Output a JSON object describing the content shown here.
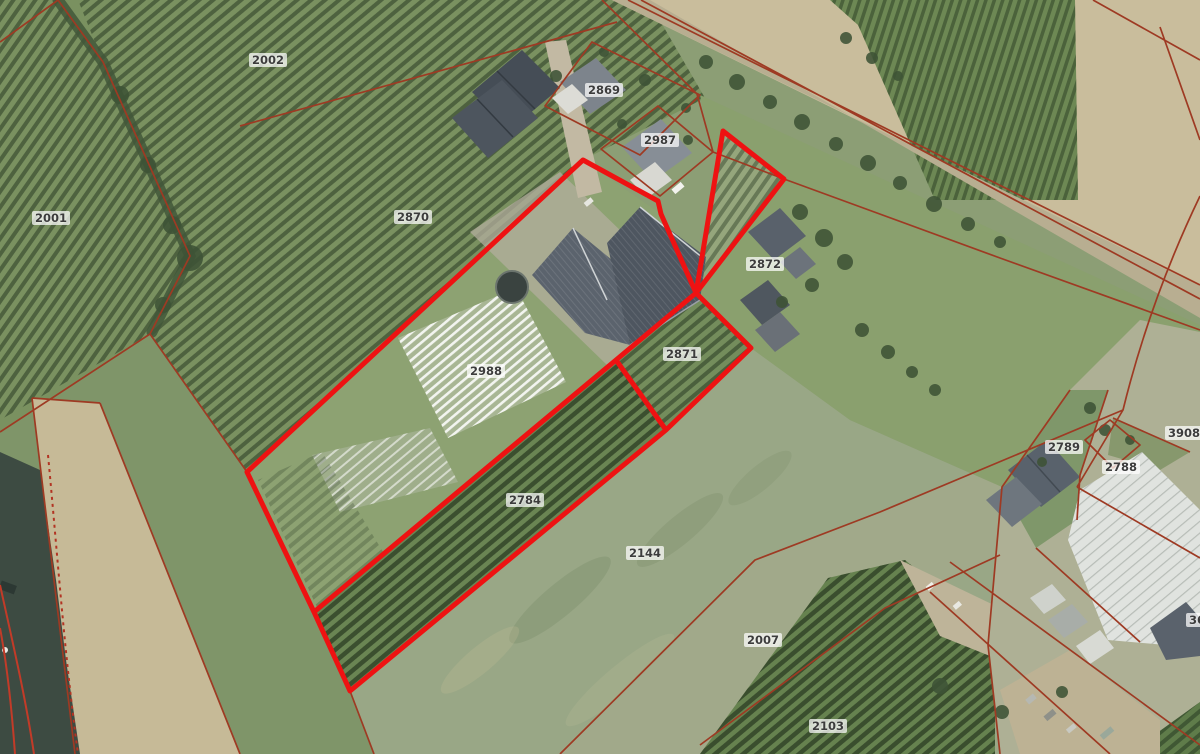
{
  "map": {
    "description": "Aerial cadastral map view with parcel boundaries; selected parcels outlined in thick red",
    "selection_outline_color": "#ee1212",
    "cadastral_line_color": "#9e3a23",
    "parcel_labels": [
      {
        "id": "2002",
        "x": 268,
        "y": 60
      },
      {
        "id": "2869",
        "x": 604,
        "y": 90
      },
      {
        "id": "2987",
        "x": 660,
        "y": 140
      },
      {
        "id": "2001",
        "x": 51,
        "y": 218
      },
      {
        "id": "2870",
        "x": 413,
        "y": 217
      },
      {
        "id": "2872",
        "x": 765,
        "y": 264
      },
      {
        "id": "2871",
        "x": 682,
        "y": 354
      },
      {
        "id": "2988",
        "x": 486,
        "y": 371
      },
      {
        "id": "3908",
        "x": 1184,
        "y": 433
      },
      {
        "id": "2789",
        "x": 1064,
        "y": 447
      },
      {
        "id": "2788",
        "x": 1121,
        "y": 467
      },
      {
        "id": "2784",
        "x": 525,
        "y": 500
      },
      {
        "id": "2144",
        "x": 645,
        "y": 553
      },
      {
        "id": "2007",
        "x": 763,
        "y": 640
      },
      {
        "id": "369",
        "x": 1201,
        "y": 620
      },
      {
        "id": "2103",
        "x": 828,
        "y": 726
      }
    ]
  }
}
